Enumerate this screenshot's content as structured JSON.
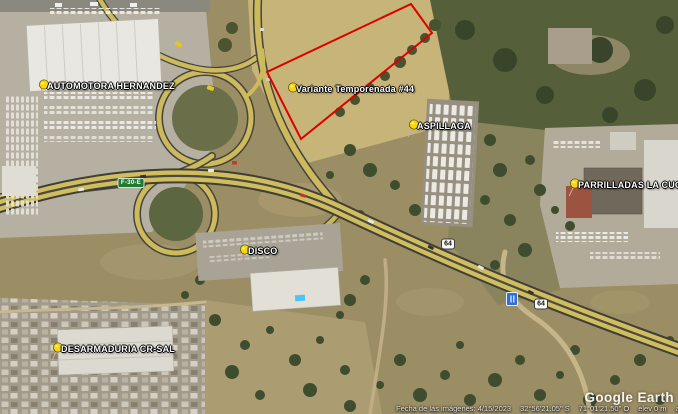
{
  "app": {
    "watermark": "Google Earth"
  },
  "parcel": {
    "points": "411,4 432,33 301,139 267,72",
    "outline_color": "#dd0000"
  },
  "placemarks": [
    {
      "label": "AUTOMOTORA HERNANDEZ"
    },
    {
      "label": "Variante Temporenada #44"
    },
    {
      "label": "ASPILLAGA"
    },
    {
      "label": "PARRILLADAS LA CUCA"
    },
    {
      "label": "DISCO"
    },
    {
      "label": "DESARMADURIA CR-SAL"
    }
  ],
  "route_shields": [
    {
      "label": "F-30-E"
    },
    {
      "label": "64"
    },
    {
      "label": "64"
    }
  ],
  "poi": {
    "blue_icon": "restaurant-poi"
  },
  "status_bar": {
    "imagery_date": "Fecha de las imágenes: 4/15/2023",
    "latitude": "32°56'21.05\" S",
    "longitude": "71°01'21.50\" O",
    "elevation": "elev 0 m",
    "eye_altitude": "alt. ojo 811 m"
  },
  "colors": {
    "pushpin": "#f6d80b",
    "shield_green": "#1f7a33",
    "parcel_outline": "#dd0000",
    "poi_blue": "#2f6fd6"
  }
}
